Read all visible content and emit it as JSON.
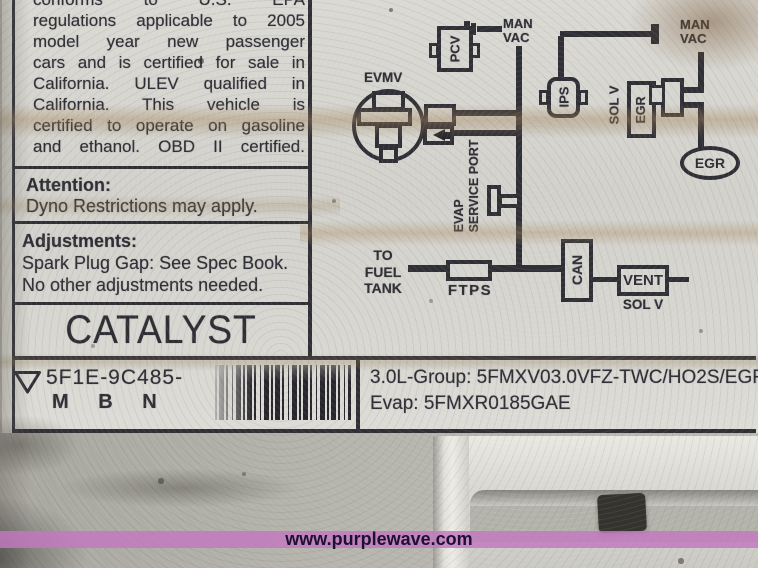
{
  "emission_label": {
    "statement_lines": [
      "conforms to U.S. EPA",
      "regulations applicable to 2005",
      "model year new passenger",
      "cars and is certified for sale in",
      "California. ULEV qualified in",
      "California. This vehicle is",
      "certified to operate on gasoline",
      "and ethanol. OBD II certified."
    ],
    "attention": {
      "heading": "Attention:",
      "body": "Dyno Restrictions may apply."
    },
    "adjustments": {
      "heading": "Adjustments:",
      "line1": "Spark Plug Gap: See Spec Book.",
      "line2": "No other adjustments needed."
    },
    "catalyst_text": "CATALYST",
    "part_code": {
      "prefix": "5F1E-9C485-",
      "suffix": "M B N"
    },
    "certification": {
      "group_line": "3.0L-Group: 5FMXV03.0VFZ-TWC/HO2S/EGR/S",
      "evap_line": "Evap: 5FMXR0185GAE"
    }
  },
  "vacuum_diagram": {
    "pcv_label": "PCV",
    "man_vac_left": "MAN\nVAC",
    "man_vac_right": "MAN\nVAC",
    "evmv_label": "EVMV",
    "ips_label": "IPS",
    "egr_solenoid": {
      "sol_v": "SOL V",
      "egr": "EGR"
    },
    "egr_valve_label": "EGR",
    "evap_service_port": "EVAP\nSERVICE PORT",
    "to_fuel_tank": "TO\nFUEL\nTANK",
    "ftps_label": "FTPS",
    "canister_label": "CAN",
    "vent_solenoid": {
      "vent": "VENT",
      "sol_v": "SOL V"
    }
  },
  "watermark": {
    "url_text": "www.purplewave.com",
    "bar_color": "#c278c0"
  },
  "icons": {
    "manufacturer_mark": "triangle-outline-icon",
    "barcode": "barcode",
    "flow_arrow": "arrow-left-icon",
    "hose_nipple": "hose-nipple-icon"
  },
  "colors": {
    "ink": "#2f2f36",
    "paper": "#d6d5d0",
    "background": "#b2b0ab"
  }
}
